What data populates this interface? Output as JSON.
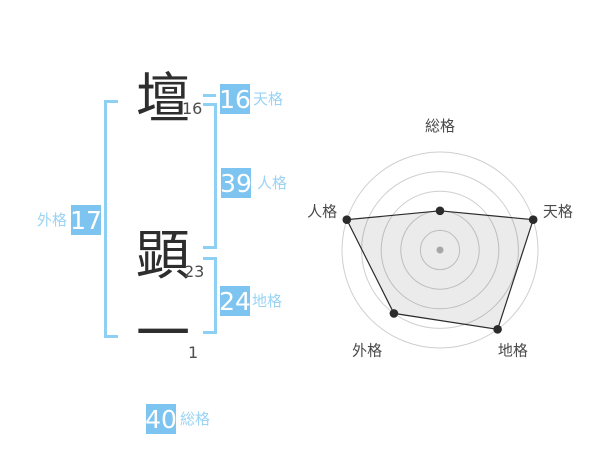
{
  "page": {
    "background": "#ffffff"
  },
  "name_diagram": {
    "characters": [
      {
        "char": "壇",
        "strokes": "16"
      },
      {
        "char": "顕",
        "strokes": "23"
      },
      {
        "char": "一",
        "strokes": "1"
      }
    ],
    "scores": [
      {
        "id": "tenkaku",
        "label": "天格",
        "value": "16"
      },
      {
        "id": "jinkaku",
        "label": "人格",
        "value": "39"
      },
      {
        "id": "chikaku",
        "label": "地格",
        "value": "24"
      },
      {
        "id": "gaikaku",
        "label": "外格",
        "value": "17"
      },
      {
        "id": "soukaku",
        "label": "総格",
        "value": "40"
      }
    ],
    "colors": {
      "box_blue": "#7dc5f0",
      "line_blue": "#8ed0f4",
      "label_blue": "#9bd3f5",
      "value_text": "#ffffff",
      "kanji_text": "#2e2e2e",
      "stroke_count_text": "#4d4d4d"
    }
  },
  "chart_data": {
    "type": "radar",
    "axes": [
      "総格",
      "天格",
      "地格",
      "外格",
      "人格"
    ],
    "series": [
      {
        "name": "name-fortune-scores",
        "values_percent": [
          40,
          100,
          100,
          80,
          100
        ]
      }
    ],
    "max_percent": 100,
    "rings": 5,
    "grid_shape": "concentric-circles",
    "start_axis": "top",
    "direction": "clockwise",
    "legend": "none",
    "colors": {
      "ring": "#cfcfcf",
      "polygon_stroke": "#2b2b2b",
      "polygon_fill": "rgba(0,0,0,0.08)",
      "point": "#2b2b2b",
      "center_dot": "#b5b5b5",
      "axis_label": "#4a4a4a"
    }
  }
}
